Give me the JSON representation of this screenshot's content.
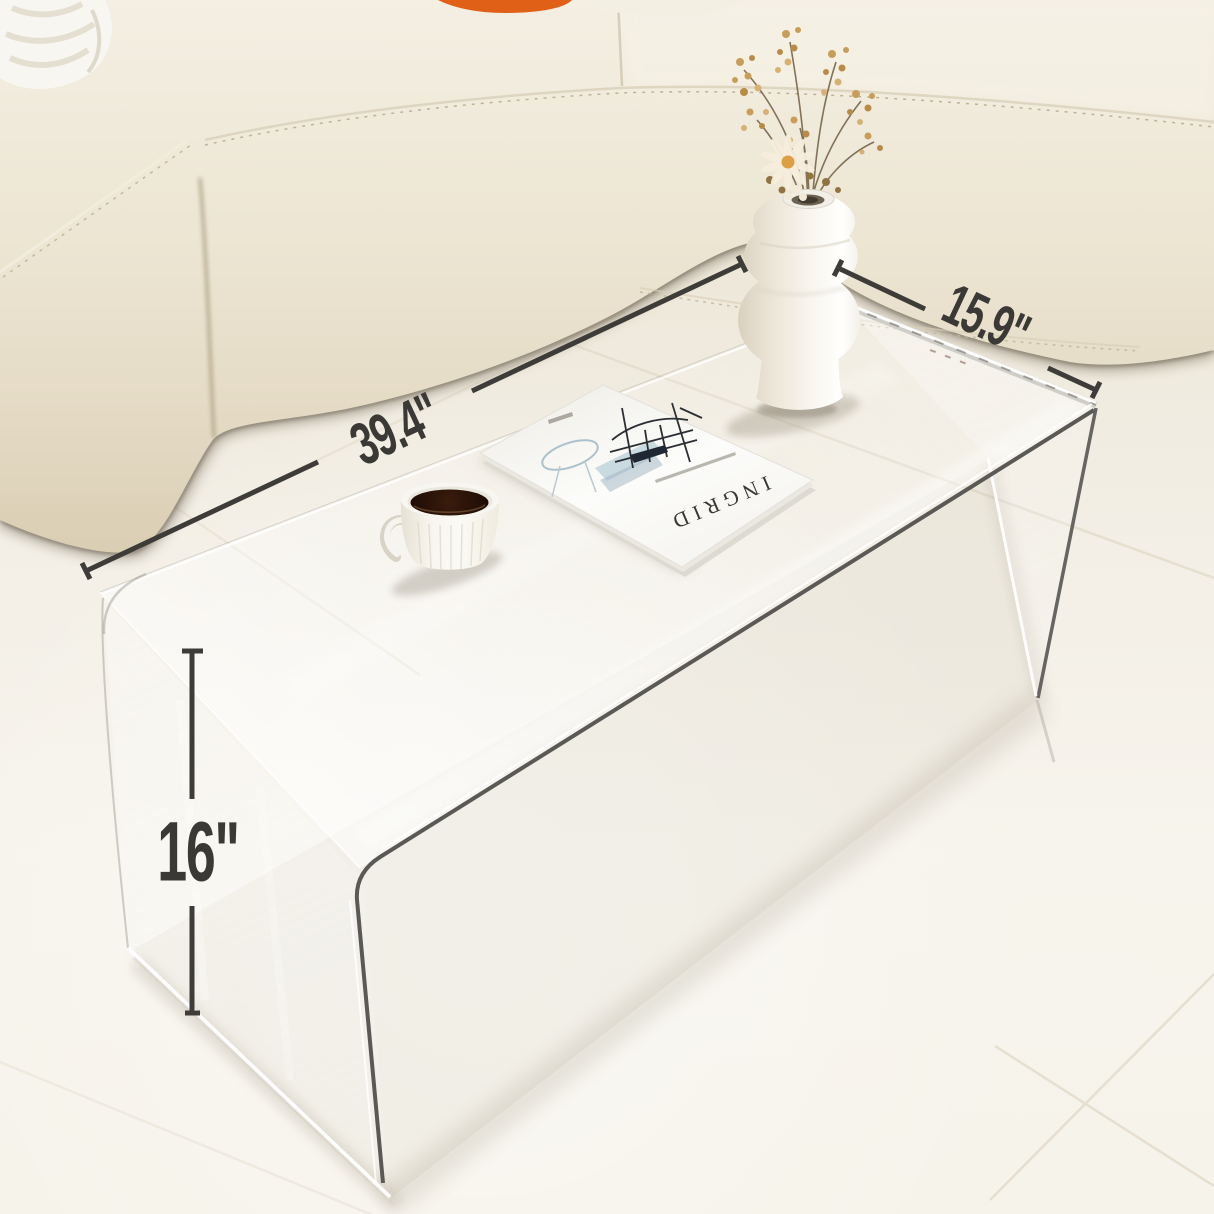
{
  "annotations": {
    "color": "#3b3936",
    "length_label": "39.4\"",
    "depth_label": "15.9\"",
    "height_label": "16\""
  },
  "magazine": {
    "title": "INGRID",
    "title_color": "#3a3732"
  },
  "palette": {
    "floor": "#f3efe6",
    "sofa_leather": "#ece5d2",
    "sofa_shadow": "#6b5e4b",
    "pillow_orange": "#e06018",
    "knit_blanket": "#f8f6f1",
    "acrylic_edge_dark": "#5b5955",
    "acrylic_highlight": "#ffffff",
    "coffee": "#2a1207",
    "cup": "#f7f6f1",
    "vase": "#f9f6f0",
    "dried_flowers": "#c89d58",
    "daisy_center": "#dca043"
  }
}
